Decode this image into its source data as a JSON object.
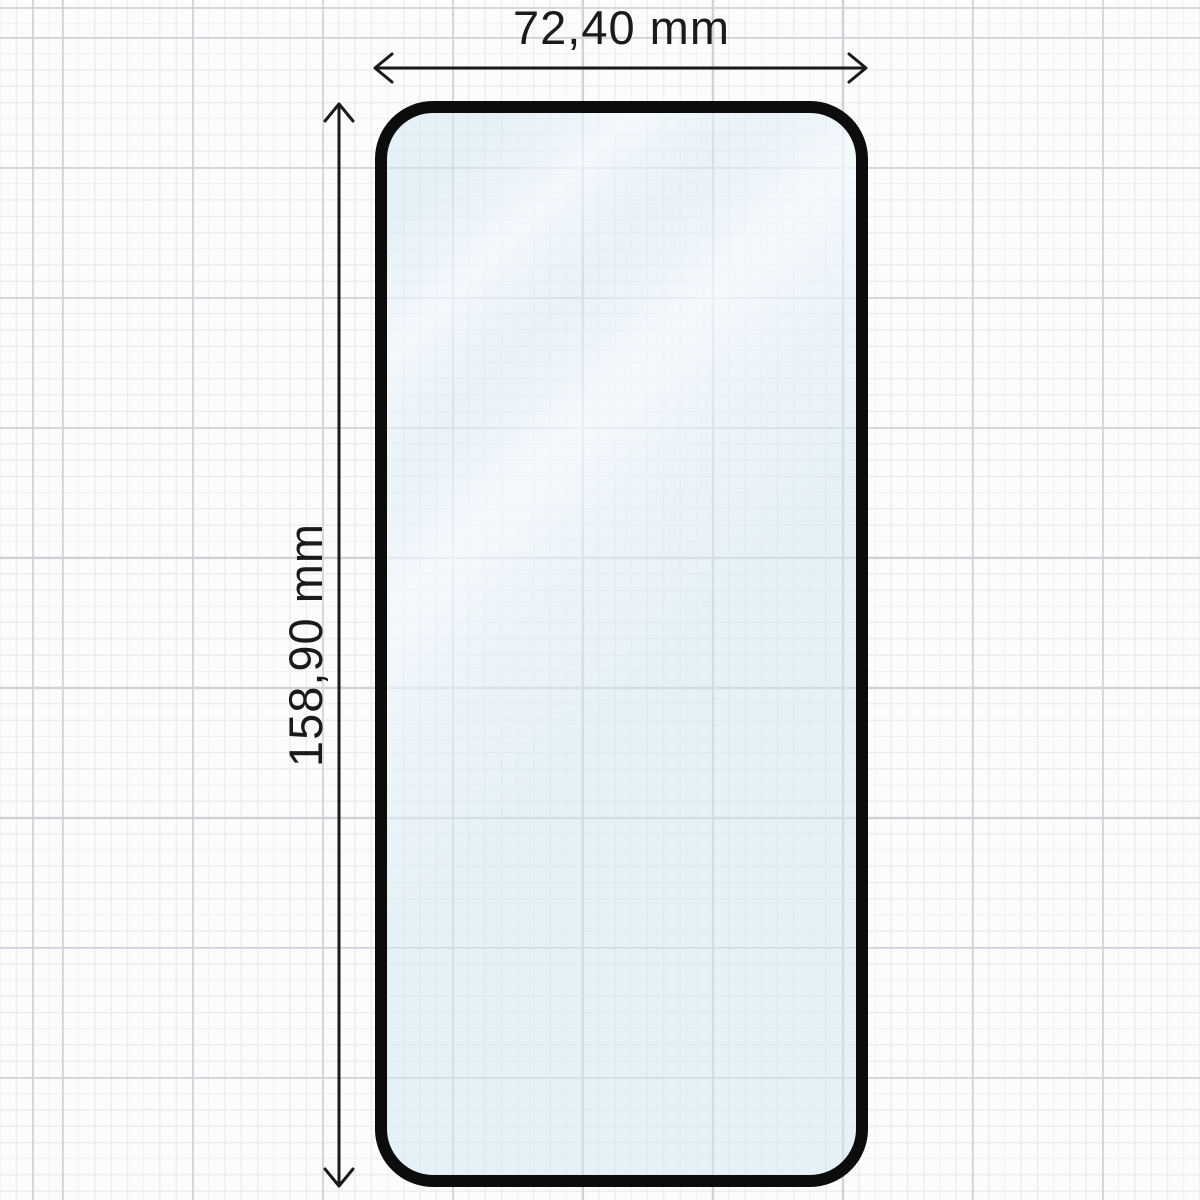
{
  "page": {
    "title": "Screen protector dimension diagram"
  },
  "diagram": {
    "width_dimension": {
      "label": "72,40 mm"
    },
    "height_dimension": {
      "label": "158,90 mm"
    },
    "colors": {
      "background": "#fcfcfd",
      "grid_minor": "#eaeaef",
      "grid_major": "#d1d1d7",
      "glass_border": "#0c0c0c",
      "glass_tint": "#e8f2f7",
      "dimension_ink": "#1a1a1a"
    }
  }
}
